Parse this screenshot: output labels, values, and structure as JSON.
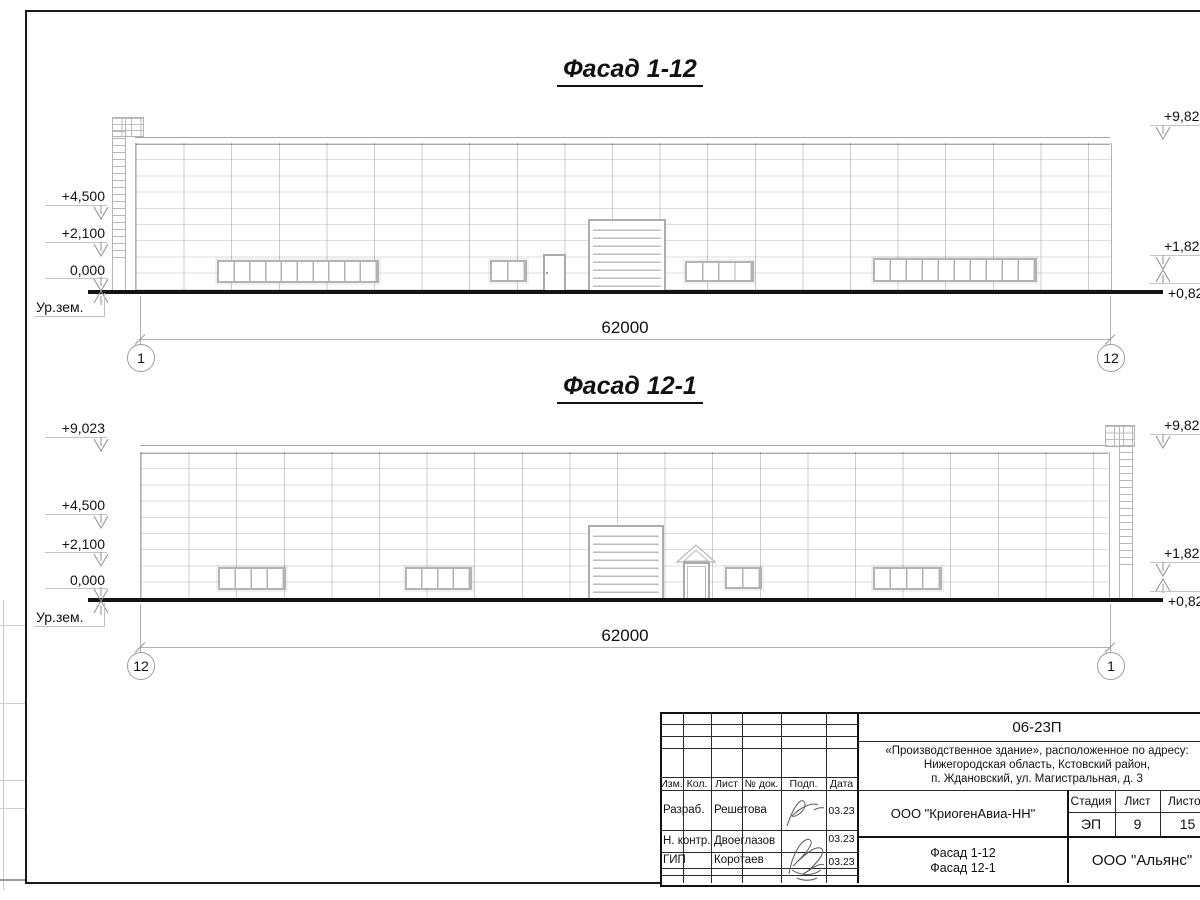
{
  "sheet": {
    "facades": [
      {
        "title": "Фасад 1-12",
        "dimension": "62000",
        "axis_start": "1",
        "axis_end": "12",
        "marks_left": [
          {
            "label": "+4,500"
          },
          {
            "label": "+2,100"
          },
          {
            "label": "0,000"
          },
          {
            "label": "Ур.зем."
          }
        ],
        "marks_right": [
          {
            "label": "+9,82"
          },
          {
            "label": "+1,82"
          },
          {
            "label": "+0,82"
          }
        ]
      },
      {
        "title": "Фасад 12-1",
        "dimension": "62000",
        "axis_start": "12",
        "axis_end": "1",
        "marks_left": [
          {
            "label": "+9,023"
          },
          {
            "label": "+4,500"
          },
          {
            "label": "+2,100"
          },
          {
            "label": "0,000"
          },
          {
            "label": "Ур.зем."
          }
        ],
        "marks_right": [
          {
            "label": "+9,82"
          },
          {
            "label": "+1,82"
          },
          {
            "label": "+0,82"
          }
        ]
      }
    ],
    "title_block": {
      "doc_number": "06-23П",
      "project_description_line1": "«Производственное здание», расположенное по адресу:",
      "project_description_line2": "Нижегородская область, Кстовский район,",
      "project_description_line3": "п. Ждановский, ул. Магистральная, д. 3",
      "col_headers": [
        {
          "label": "Изм."
        },
        {
          "label": "Кол."
        },
        {
          "label": "Лист"
        },
        {
          "label": "№ док."
        },
        {
          "label": "Подп."
        },
        {
          "label": "Дата"
        }
      ],
      "staff": [
        {
          "role": "Разраб.",
          "name": "Решетова",
          "date": "03.23"
        },
        {
          "role": "Н. контр.",
          "name": "Двоеглазов",
          "date": "03.23"
        },
        {
          "role": "ГИП",
          "name": "Коротаев",
          "date": "03.23"
        }
      ],
      "company": "ООО \"КриогенАвиа-НН\"",
      "stage_header": "Стадия",
      "sheet_header": "Лист",
      "sheets_header": "Листов",
      "stage": "ЭП",
      "sheet_num": "9",
      "sheets_total": "15",
      "drawing_title_line1": "Фасад 1-12",
      "drawing_title_line2": "Фасад 12-1",
      "contractor": "ООО \"Альянс\""
    },
    "colors": {
      "line_dark": "#141414",
      "line_light": "#b3b3b3",
      "text": "#111111"
    }
  }
}
